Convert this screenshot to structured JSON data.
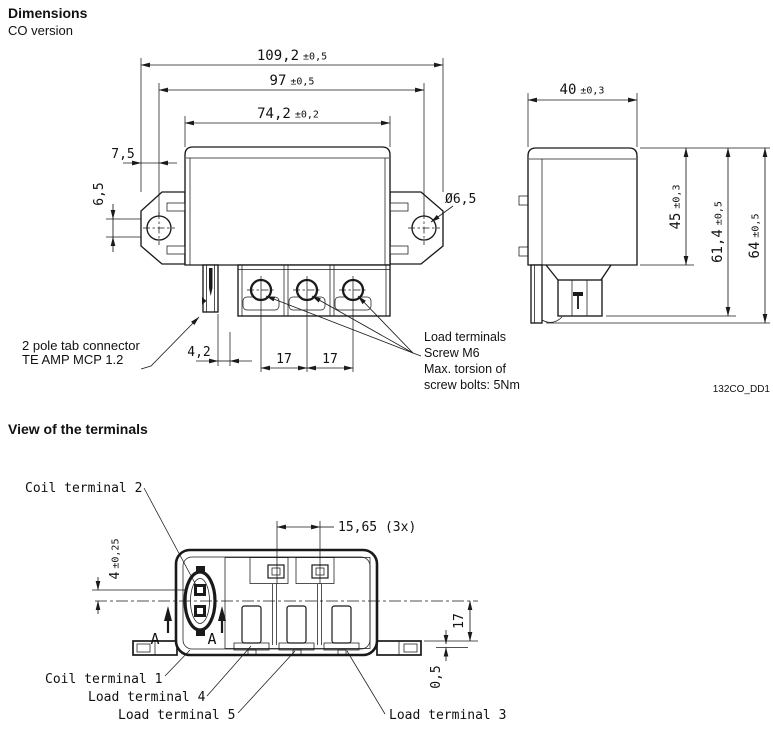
{
  "colors": {
    "line": "#1a1a1a",
    "text": "#111111",
    "background": "#ffffff"
  },
  "header": {
    "title": "Dimensions",
    "subtitle": "CO version"
  },
  "drawing_code": "132CO_DD1",
  "front_view": {
    "dim_overall_width": {
      "value": "109,2",
      "tol": "±0,5"
    },
    "dim_mounting_hole_span": {
      "value": "97",
      "tol": "±0,5"
    },
    "dim_body_width": {
      "value": "74,2",
      "tol": "±0,2"
    },
    "dim_ear_to_hole": "7,5",
    "dim_hole_vertical_offset": "6,5",
    "dim_mounting_hole_diameter": "Ø6,5",
    "dim_tab_offset": "4,2",
    "dim_terminal_pitch_left": "17",
    "dim_terminal_pitch_right": "17",
    "tab_connector_note": {
      "line1": "2 pole tab connector",
      "line2": "TE AMP MCP 1.2"
    },
    "load_terminals_note": {
      "line1": "Load terminals",
      "line2": "Screw M6",
      "line3": "Max. torsion of",
      "line4": "screw bolts: 5Nm"
    }
  },
  "side_view": {
    "dim_depth": {
      "value": "40",
      "tol": "±0,3"
    },
    "dim_body_height": {
      "value": "45",
      "tol": "±0,3"
    },
    "dim_height_to_terminals": {
      "value": "61,4",
      "tol": "±0,5"
    },
    "dim_overall_height": {
      "value": "64",
      "tol": "±0,5"
    }
  },
  "terminal_view": {
    "heading": "View of the terminals",
    "dim_terminal_pitch": "15,65 (3x)",
    "dim_coil_pin_offset": {
      "value": "4",
      "tol": "±0,25"
    },
    "dim_center_to_base": "17",
    "dim_standoff": "0,5",
    "section_marker": "A",
    "labels": {
      "coil_terminal_2": "Coil terminal 2",
      "coil_terminal_1": "Coil terminal 1",
      "load_terminal_4": "Load terminal 4",
      "load_terminal_5": "Load terminal 5",
      "load_terminal_3": "Load terminal 3"
    }
  }
}
